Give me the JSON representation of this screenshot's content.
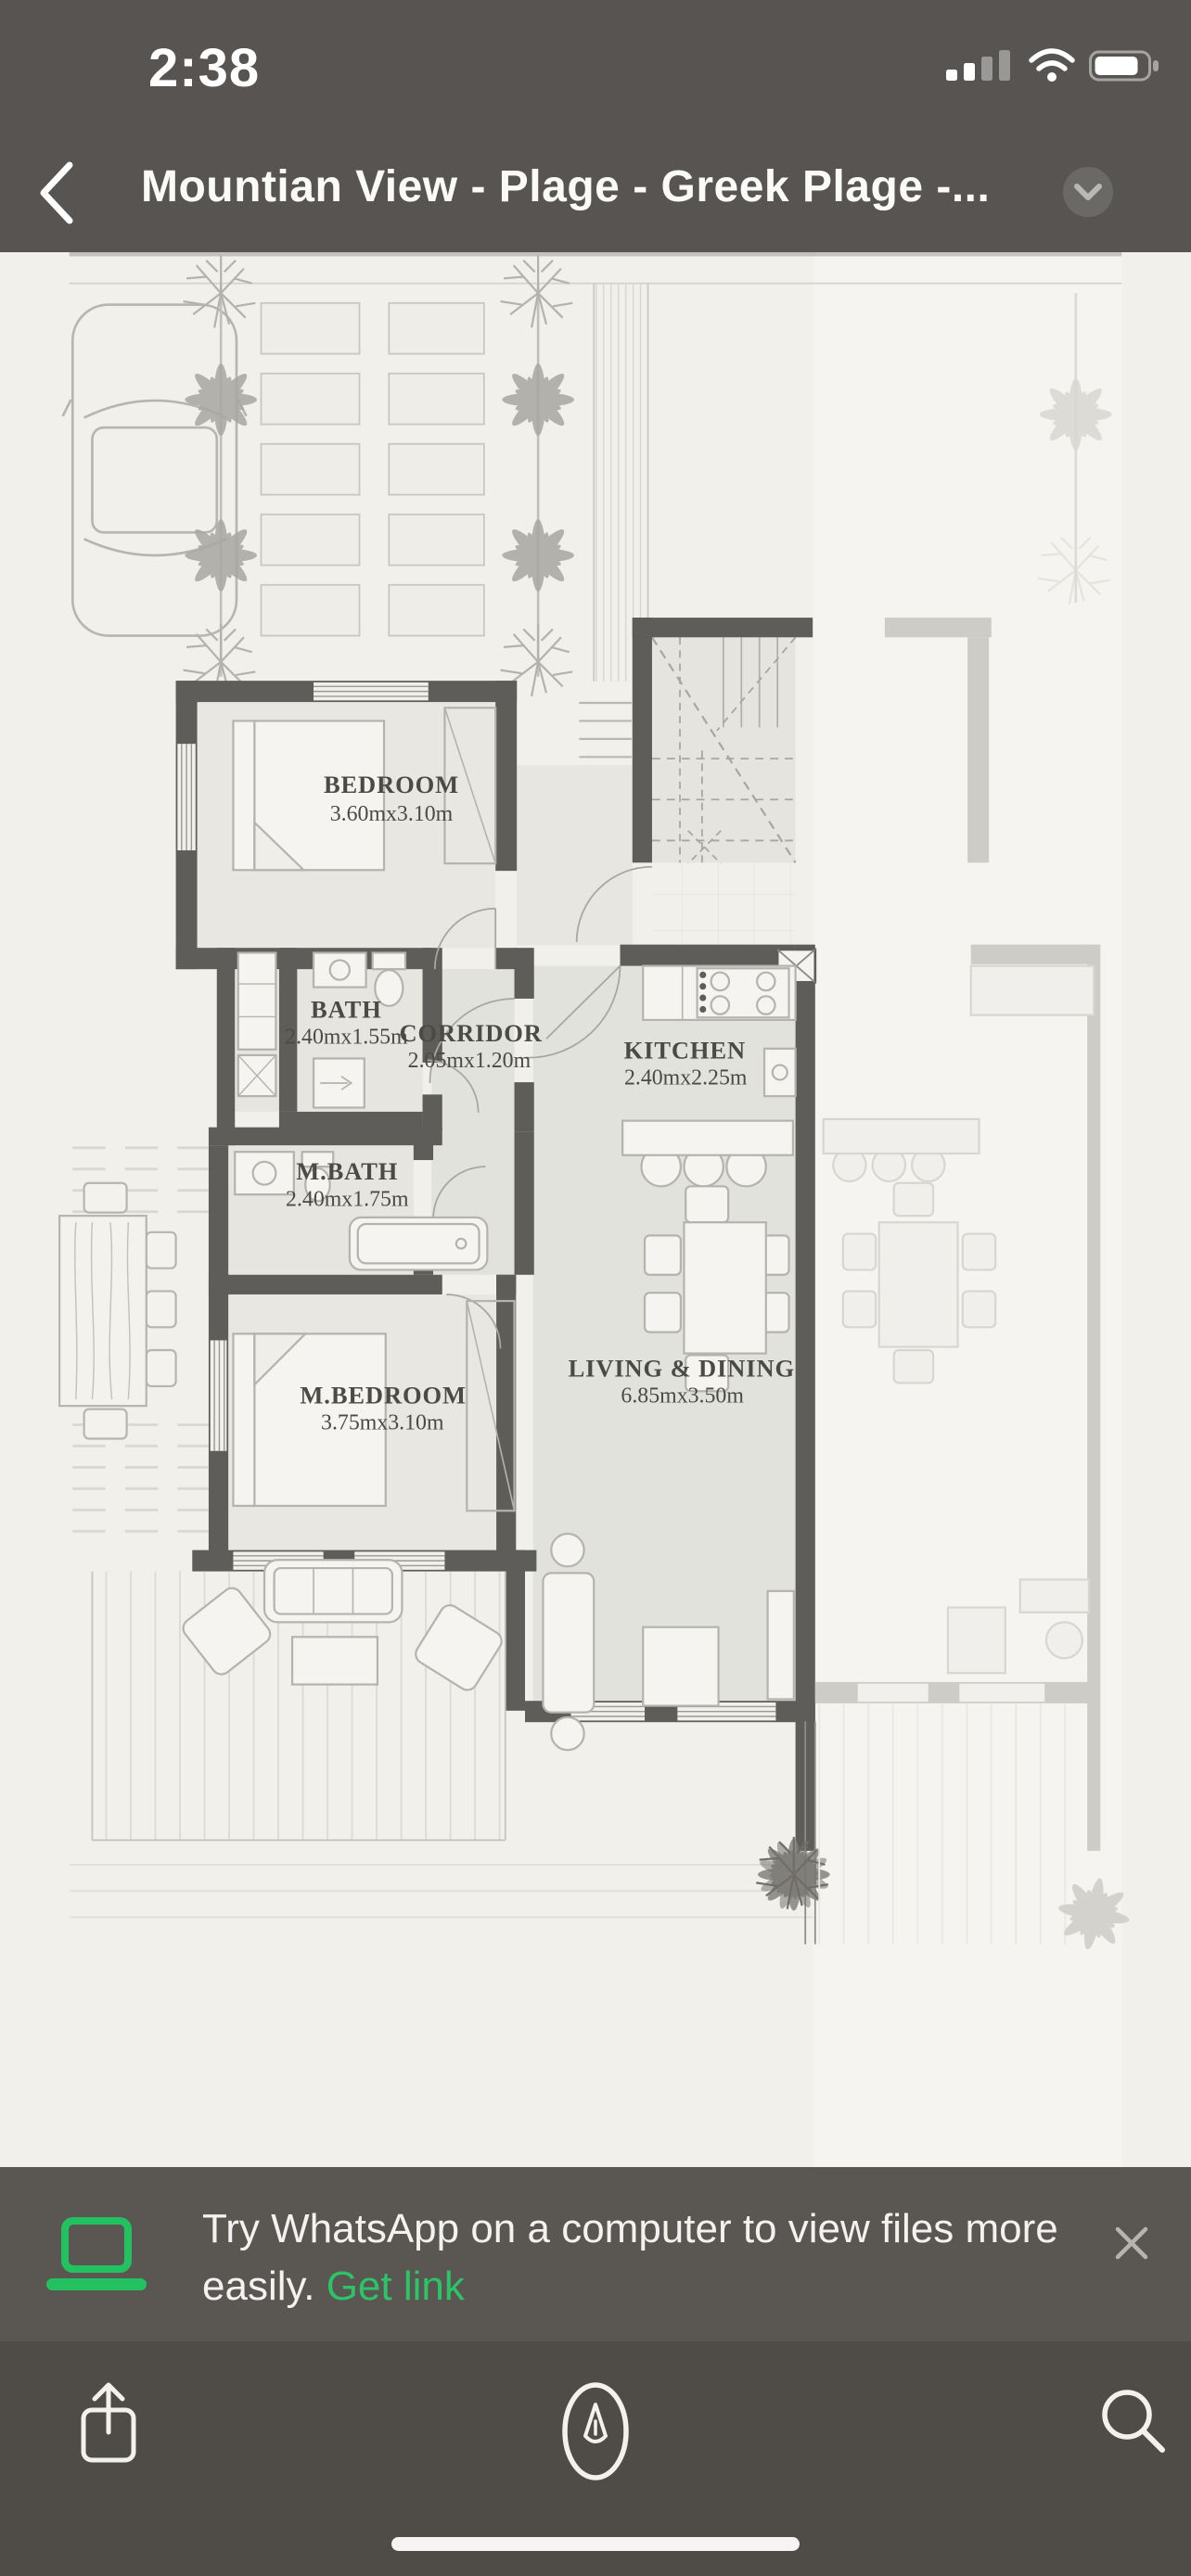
{
  "status_bar": {
    "time": "2:38",
    "icons": [
      "cellular-signal-icon",
      "wifi-icon",
      "battery-icon"
    ]
  },
  "nav": {
    "back_icon": "chevron-left-icon",
    "title": "Mountian View - Plage - Greek Plage -...",
    "collapse_icon": "chevron-down-icon"
  },
  "plan": {
    "rooms": [
      {
        "name": "BEDROOM",
        "dims": "3.60mx3.10m"
      },
      {
        "name": "BATH",
        "dims": "2.40mx1.55m"
      },
      {
        "name": "CORRIDOR",
        "dims": "2.05mx1.20m"
      },
      {
        "name": "KITCHEN",
        "dims": "2.40mx2.25m"
      },
      {
        "name": "M.BATH",
        "dims": "2.40mx1.75m"
      },
      {
        "name": "M.BEDROOM",
        "dims": "3.75mx3.10m"
      },
      {
        "name": "LIVING & DINING",
        "dims": "6.85mx3.50m"
      }
    ]
  },
  "banner": {
    "laptop_icon": "laptop-icon",
    "message": "Try WhatsApp on a computer to view files more easily.",
    "link_label": "Get link",
    "close_icon": "close-icon"
  },
  "toolbar": {
    "share_icon": "share-icon",
    "markup_icon": "markup-icon",
    "search_icon": "search-icon"
  },
  "colors": {
    "header_bg": "#575451",
    "accent_green": "#2dc468",
    "paper": "#f1f0eb",
    "wall": "#5f5d59"
  }
}
